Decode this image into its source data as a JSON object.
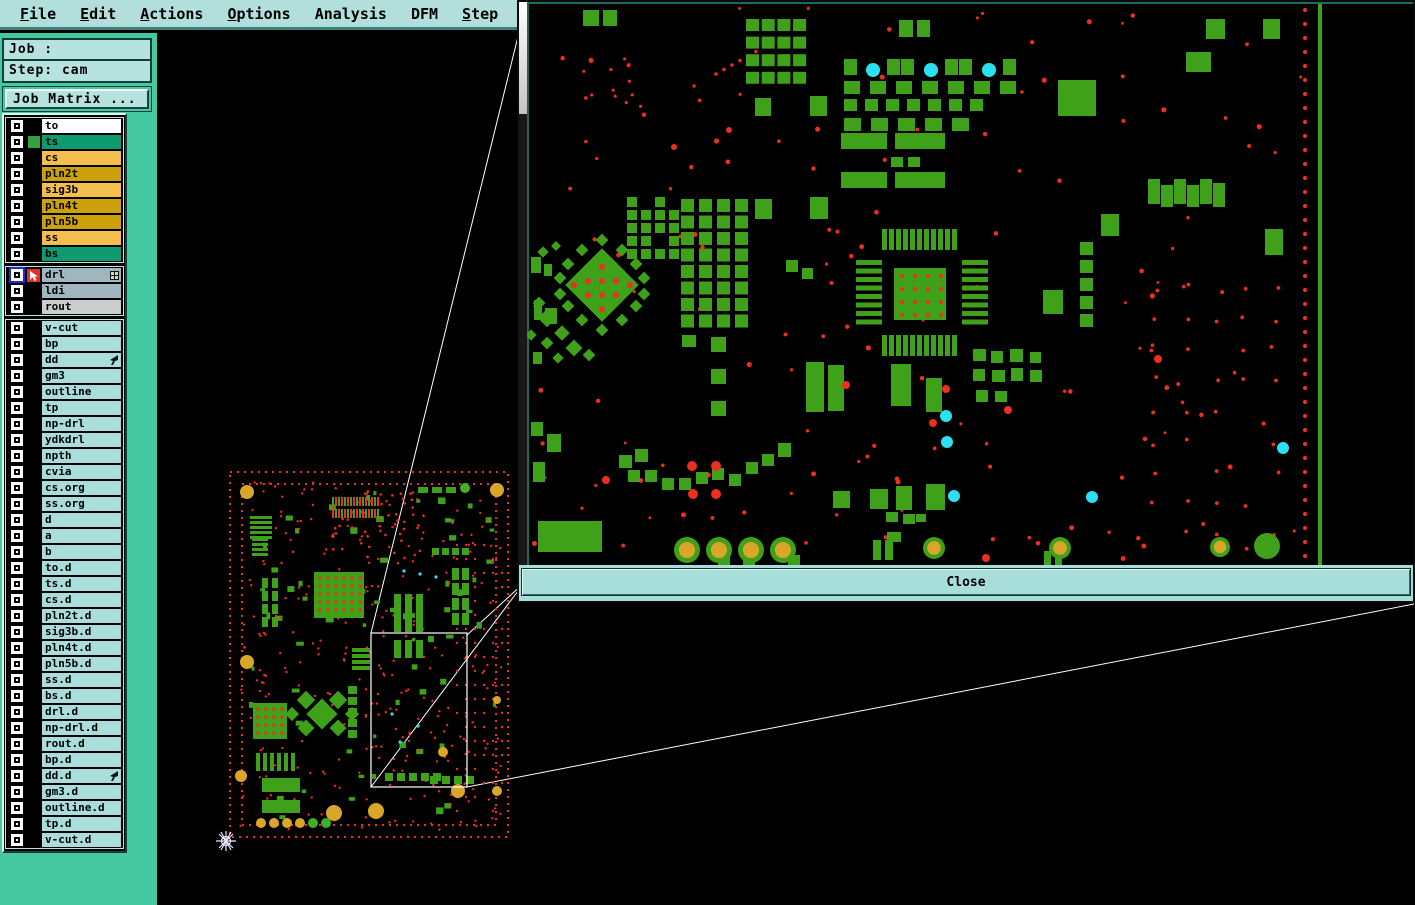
{
  "menu_bar": {
    "items": [
      {
        "label": "File",
        "underline_first": true
      },
      {
        "label": "Edit",
        "underline_first": true
      },
      {
        "label": "Actions",
        "underline_first": true
      },
      {
        "label": "Options",
        "underline_first": true
      },
      {
        "label": "Analysis",
        "underline_first": false
      },
      {
        "label": "DFM",
        "underline_first": false
      },
      {
        "label": "Step",
        "underline_first": true
      },
      {
        "label": "Rout",
        "underline_first": true
      },
      {
        "label": "Windows",
        "underline_first": true
      }
    ]
  },
  "job_panel": {
    "job_text": "Job : 6v2g2ly5a0",
    "step_text": "Step: cam",
    "job_matrix_button": "Job Matrix ..."
  },
  "layer_list": {
    "groups": [
      {
        "name": "board-layers",
        "rows": [
          {
            "label": "to",
            "color": "#ffffff"
          },
          {
            "label": "ts",
            "color": "#0f9b70",
            "swatch": "#35a040"
          },
          {
            "label": "cs",
            "color": "#f4be4e"
          },
          {
            "label": "pln2t",
            "color": "#cda10b"
          },
          {
            "label": "sig3b",
            "color": "#f4be4e"
          },
          {
            "label": "pln4t",
            "color": "#cda10b"
          },
          {
            "label": "pln5b",
            "color": "#cda10b"
          },
          {
            "label": "ss",
            "color": "#f4be4e"
          },
          {
            "label": "bs",
            "color": "#0f9b70"
          }
        ]
      },
      {
        "name": "drill-layers",
        "rows": [
          {
            "label": "drl",
            "color": "#9fb6be",
            "selected": true,
            "cursor_icon": true,
            "grid_icon": true
          },
          {
            "label": "ldi",
            "color": "#9fb6be"
          },
          {
            "label": "rout",
            "color": "#c9cfcf"
          }
        ]
      },
      {
        "name": "misc-layers",
        "rows": [
          {
            "label": "v-cut",
            "color": "#abdcdc"
          },
          {
            "label": "bp",
            "color": "#abdcdc"
          },
          {
            "label": "dd",
            "color": "#abdcdc",
            "pointer_icon": true
          },
          {
            "label": "gm3",
            "color": "#abdcdc"
          },
          {
            "label": "outline",
            "color": "#abdcdc"
          },
          {
            "label": "tp",
            "color": "#abdcdc"
          },
          {
            "label": "np-drl",
            "color": "#abdcdc"
          },
          {
            "label": "ydkdrl",
            "color": "#abdcdc"
          },
          {
            "label": "npth",
            "color": "#abdcdc"
          },
          {
            "label": "cvia",
            "color": "#abdcdc"
          },
          {
            "label": "cs.org",
            "color": "#abdcdc"
          },
          {
            "label": "ss.org",
            "color": "#abdcdc"
          },
          {
            "label": "d",
            "color": "#abdcdc"
          },
          {
            "label": "a",
            "color": "#abdcdc"
          },
          {
            "label": "b",
            "color": "#abdcdc"
          },
          {
            "label": "to.d",
            "color": "#abdcdc"
          },
          {
            "label": "ts.d",
            "color": "#abdcdc"
          },
          {
            "label": "cs.d",
            "color": "#abdcdc"
          },
          {
            "label": "pln2t.d",
            "color": "#abdcdc"
          },
          {
            "label": "sig3b.d",
            "color": "#abdcdc"
          },
          {
            "label": "pln4t.d",
            "color": "#abdcdc"
          },
          {
            "label": "pln5b.d",
            "color": "#abdcdc"
          },
          {
            "label": "ss.d",
            "color": "#abdcdc"
          },
          {
            "label": "bs.d",
            "color": "#abdcdc"
          },
          {
            "label": "drl.d",
            "color": "#abdcdc"
          },
          {
            "label": "np-drl.d",
            "color": "#abdcdc"
          },
          {
            "label": "rout.d",
            "color": "#abdcdc"
          },
          {
            "label": "bp.d",
            "color": "#abdcdc"
          },
          {
            "label": "dd.d",
            "color": "#abdcdc",
            "pointer_icon": true
          },
          {
            "label": "gm3.d",
            "color": "#abdcdc"
          },
          {
            "label": "outline.d",
            "color": "#abdcdc"
          },
          {
            "label": "tp.d",
            "color": "#abdcdc"
          },
          {
            "label": "v-cut.d",
            "color": "#abdcdc"
          }
        ]
      }
    ]
  },
  "popup": {
    "close_label": "Close"
  },
  "icons": {
    "drl_cursor_icon": "white nw-arrow cursor on red square",
    "matrix_grid_icon": "small grid cell icon",
    "layer_pointer_icon": "small black sw-pointer",
    "origin_star_icon": "8-spoke origin star marker"
  },
  "colors": {
    "menubar_bg": "#b2dedb",
    "sidebar_green": "#46c8a0",
    "panel_cyan": "#abdcdc",
    "pcb_green": "#3fa01a",
    "drill_red": "#ee2e1e",
    "via_cyan": "#2be0f2",
    "hole_orange": "#d9a62a",
    "canvas_black": "#000000",
    "connector_line": "#ffffff",
    "selected_checkbox_blue": "#2626d8"
  }
}
